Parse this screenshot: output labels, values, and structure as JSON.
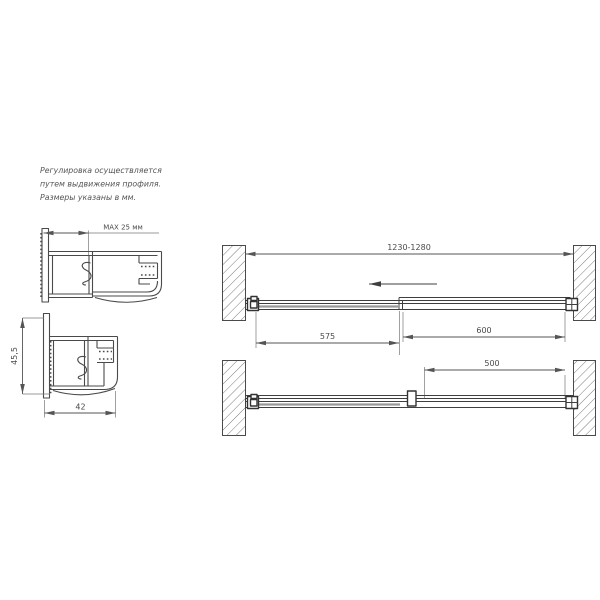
{
  "note": {
    "line1": "Регулировка осуществляется",
    "line2": "путем выдвижения профиля.",
    "line3": "Размеры указаны в мм."
  },
  "wall_profile_section": {
    "max_adjust_label": "MAX 25 мм"
  },
  "door_profile_section": {
    "height_label": "45,5",
    "width_label": "42"
  },
  "layout_open": {
    "total_width_label": "1230-1280",
    "sliding_panel_label": "575",
    "fixed_panel_label": "600"
  },
  "layout_closed": {
    "fixed_glass_label": "500"
  },
  "colors": {
    "line": "#4a4a4a",
    "dimension": "#555555",
    "glass": "#999999",
    "background": "#ffffff"
  }
}
